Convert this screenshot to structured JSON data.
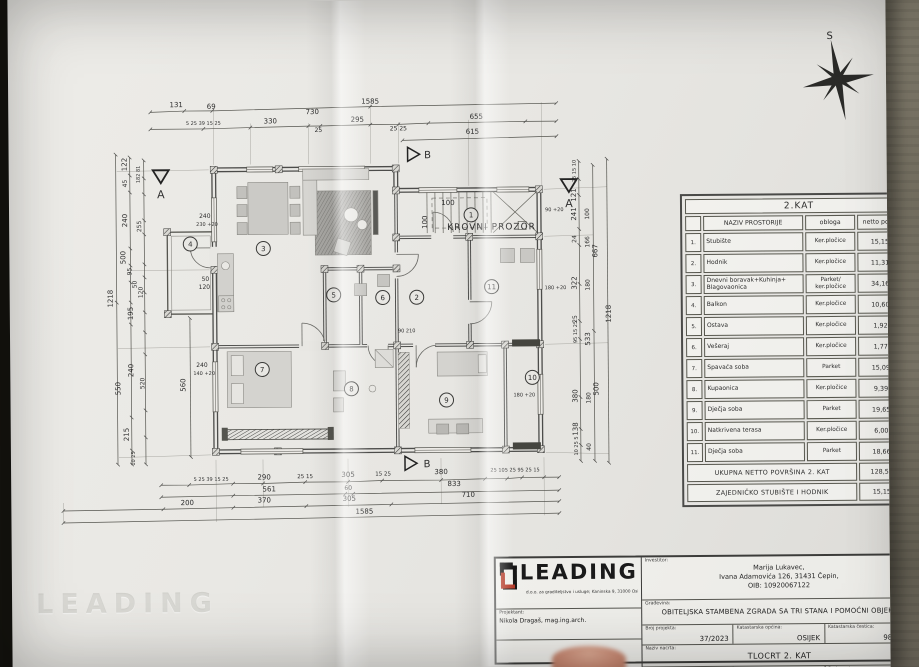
{
  "compass": {
    "north_label": "S"
  },
  "watermark": "LEADING",
  "plan": {
    "krovni_prozor_label": "KROVNI PROZOR",
    "section_a": "A",
    "section_b": "B",
    "room_numbers": [
      "1",
      "2",
      "3",
      "4",
      "5",
      "6",
      "7",
      "8",
      "9",
      "10",
      "11"
    ],
    "dims": {
      "t1": [
        "131",
        "69",
        "1585"
      ],
      "t2": [
        "5 25 39 15 25",
        "330",
        "730",
        "25",
        "295",
        "25 25",
        "655"
      ],
      "t3": [
        "615"
      ],
      "b1": [
        "5 25 39 15 25",
        "290",
        "25 15",
        "305",
        "15 25",
        "380",
        "25 105 25 95 25 15"
      ],
      "b2": [
        "561",
        "60",
        "833"
      ],
      "b3": [
        "200",
        "370",
        "305",
        "710"
      ],
      "b4": [
        "1585"
      ],
      "left": [
        "122",
        "45",
        "182 81",
        "240",
        "255",
        "500",
        "95",
        "50",
        "120",
        "195",
        "550",
        "240",
        "520",
        "215",
        "10 25",
        "560",
        "1218"
      ],
      "right": [
        "25 15 10",
        "121",
        "100",
        "241",
        "24",
        "166",
        "322",
        "180",
        "25",
        "95 15 25",
        "533",
        "380",
        "180",
        "138",
        "10 25 5",
        "40",
        "667",
        "500",
        "1218"
      ],
      "inner": [
        "240",
        "230 +20",
        "50",
        "120",
        "240",
        "140 +20",
        "100",
        "100",
        "90 +20",
        "180 +20",
        "180 +20",
        "90 210"
      ]
    }
  },
  "room_table": {
    "title": "2.KAT",
    "columns": {
      "name": "NAZIV PROSTORIJE",
      "finish": "obloga",
      "area": "netto površina"
    },
    "rows": [
      {
        "num": "1.",
        "name": "Stubište",
        "finish": "Ker.pločice",
        "area": "15,15 m²"
      },
      {
        "num": "2.",
        "name": "Hodnik",
        "finish": "Ker.pločice",
        "area": "11,31 m²"
      },
      {
        "num": "3.",
        "name": "Dnevni boravak+Kuhinja+ Blagovaonica",
        "finish": "Parket/ ker.pločice",
        "area": "34,16 m²"
      },
      {
        "num": "4.",
        "name": "Balkon",
        "finish": "Ker.pločice",
        "area": "10,60 m²"
      },
      {
        "num": "5.",
        "name": "Ostava",
        "finish": "Ker.pločice",
        "area": "1,92 m²"
      },
      {
        "num": "6.",
        "name": "Vešeraj",
        "finish": "Ker.pločice",
        "area": "1,77 m²"
      },
      {
        "num": "7.",
        "name": "Spavaća soba",
        "finish": "Parket",
        "area": "15,09 m²"
      },
      {
        "num": "8.",
        "name": "Kupaonica",
        "finish": "Ker.pločice",
        "area": "9,39 m²"
      },
      {
        "num": "9.",
        "name": "Dječja soba",
        "finish": "Parket",
        "area": "19,65 m²"
      },
      {
        "num": "10.",
        "name": "Natkrivena terasa",
        "finish": "Ker.pločice",
        "area": "6,00 m²"
      },
      {
        "num": "11.",
        "name": "Dječja soba",
        "finish": "Parket",
        "area": "18,66 m²"
      }
    ],
    "totals": [
      {
        "label": "UKUPNA NETTO POVRŠINA 2. KAT",
        "area": "128,55 m²"
      },
      {
        "label": "ZAJEDNIČKO STUBIŠTE I HODNIK",
        "area": "15,15 m²"
      }
    ]
  },
  "title_block": {
    "logo_text": "LEADING",
    "logo_subtext": "d.o.o. za graditeljstvo i usluge; Kaninska 9, 31000 Osijek   GSM + 385 97 7779731",
    "projektant_label": "Projektant:",
    "projektant": "Nikola Dragaš, mag.ing.arch.",
    "projekt_label": "Projekt:",
    "projekt": "GLAVNI PROJEKT-ARHITEKTONSKI PROJEKT",
    "investitor_label": "Investitor:",
    "investitor_line1": "Marija Lukavec,",
    "investitor_line2": "Ivana Adamovića 126, 31431 Čepin,",
    "investitor_line3": "OIB: 10920067122",
    "gradevina_label": "Građevina:",
    "gradevina": "OBITELJSKA STAMBENA ZGRADA SA TRI STANA I POMOĆNI OBJEKT",
    "broj_projekta_label": "Broj projekta:",
    "broj_projekta": "37/2023",
    "kat_opcina_label": "Katastarska općina:",
    "kat_opcina": "OSIJEK",
    "kat_cestica_label": "Katastarska čestica:",
    "kat_cestica": "9827/26",
    "naziv_nacrta_label": "Naziv nacrta:",
    "naziv_nacrta": "TLOCRT 2. KAT",
    "datum_label": "Datum:",
    "datum": "TRAVANJ 2023.",
    "mjerilo_label": "Mjerilo:",
    "mjerilo": "1:100",
    "broj_nacrta_label": "Broj nacrta:",
    "broj_nacrta": "005"
  }
}
